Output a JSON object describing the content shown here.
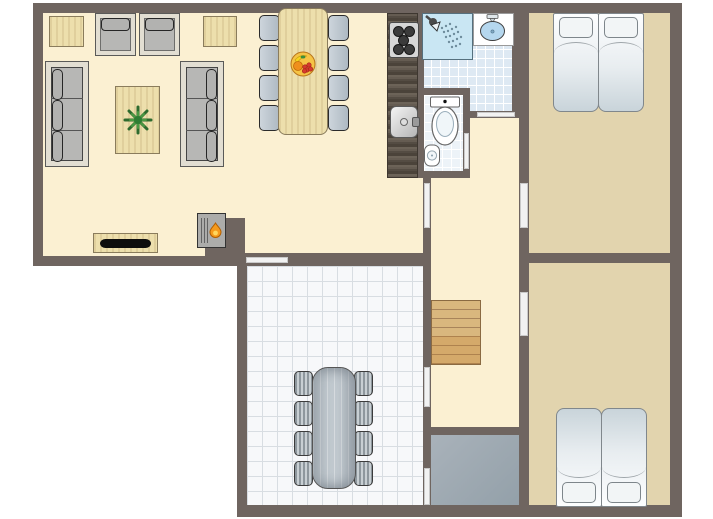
{
  "type": "floor-plan",
  "canvas": {
    "width": 713,
    "height": 519,
    "background": "#FFFFFF"
  },
  "colors": {
    "wall": "#6F6560",
    "door": "#F2F2F2",
    "door-edge": "#C9C9C9",
    "floor-cream": "#FBF0D2",
    "floor-tan": "#E2D4AE",
    "tile-floor": "#F7F8FA",
    "tile-line": "#D8DDE2",
    "bath-tile": "#DEE9F3",
    "bath-line": "#FFFFFF",
    "wood-light": "#EDDFAC",
    "wood-border": "#8A7C5C",
    "wood-dark": "#585047",
    "stairs-wood": "#D9B77E",
    "stairs-line": "#A8845A",
    "seat-gray": "#B7BFC7",
    "sofa-gray": "#B7B7B5",
    "sofa-frame": "#E2DED2",
    "utility-gray": "#9FA9B2",
    "shower-blue": "#C9E6F3",
    "fixture-blue": "#B5D7EE",
    "bed-sheet": "#E8EDF0",
    "plant-green": "#2F7D33",
    "flame-orange": "#F59A1C"
  },
  "rooms": [
    {
      "id": "living-dining-room",
      "floor": "cream",
      "furniture": [
        "sofa",
        "sofa",
        "armchair",
        "armchair",
        "side-table",
        "side-table",
        "coffee-table-with-plant",
        "tv-stand",
        "fireplace",
        "dining-table",
        "8-dining-chairs",
        "fruit-bowl"
      ]
    },
    {
      "id": "kitchen",
      "floor": "cream",
      "furniture": [
        "counter",
        "stove-5-burners",
        "sink"
      ]
    },
    {
      "id": "bathroom",
      "floor": "blue-tile",
      "furniture": [
        "shower",
        "washbasin"
      ]
    },
    {
      "id": "toilet-room",
      "floor": "light-tile",
      "furniture": [
        "toilet",
        "corner-sink"
      ]
    },
    {
      "id": "bedroom-top",
      "floor": "tan",
      "furniture": [
        "twin-bed",
        "twin-bed"
      ]
    },
    {
      "id": "bedroom-bottom",
      "floor": "tan",
      "furniture": [
        "twin-bed",
        "twin-bed"
      ]
    },
    {
      "id": "hallway",
      "floor": "cream",
      "furniture": [
        "stairs-7-treads"
      ]
    },
    {
      "id": "tiled-room",
      "floor": "white-tile",
      "furniture": [
        "long-table",
        "8-chairs"
      ]
    },
    {
      "id": "utility-room",
      "floor": "gray",
      "furniture": []
    }
  ],
  "counts": {
    "dining_chairs": 8,
    "patio_chairs": 8,
    "beds": 4,
    "sofas": 2,
    "armchairs": 2,
    "stair_treads": 7,
    "stove_burners": 5,
    "door_openings": 8
  }
}
